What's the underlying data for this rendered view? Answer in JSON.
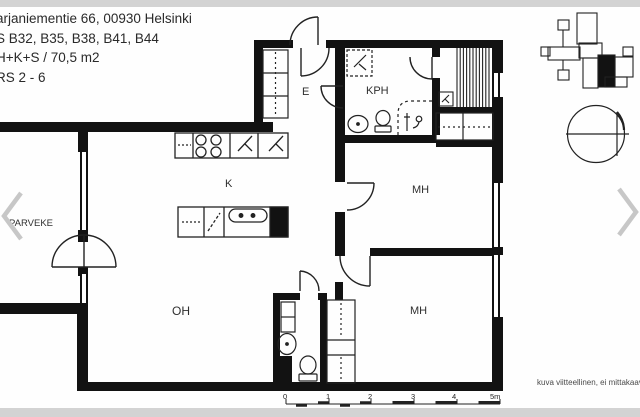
{
  "header": {
    "line1": "arjaniementie 66, 00930 Helsinki",
    "line2": "S B32, B35, B38, B41, B44",
    "line3": "H+K+S / 70,5 m2",
    "line4": "RS 2 - 6"
  },
  "rooms": {
    "parveke": "PARVEKE",
    "oh": "OH",
    "k": "K",
    "e": "E",
    "kph": "KPH",
    "mh_top": "MH",
    "mh_bottom": "MH"
  },
  "scalebar": {
    "labels": [
      "0",
      "1",
      "2",
      "3",
      "4",
      "5m"
    ]
  },
  "footer": {
    "disclaimer": "kuva viitteellinen, ei mittakaava"
  },
  "icons": [
    "stove-icon",
    "fridge-icon",
    "freezer-icon",
    "kitchen-sink-icon",
    "dishwasher-icon",
    "washer-reservation-icon",
    "bathroom-sink-icon",
    "toilet-icon",
    "shower-icon",
    "sauna-heater-icon",
    "sauna-benches",
    "wardrobe",
    "door-arc",
    "window",
    "compass-icon",
    "site-plan-map",
    "scale-bar",
    "chevron-left-icon",
    "chevron-right-icon"
  ],
  "colors": {
    "wall": "#121212",
    "line": "#222222",
    "band": "#d3d3d3",
    "chevron": "#c7c7c7",
    "text": "#2a2a2a",
    "muted": "#4a4a4a"
  }
}
